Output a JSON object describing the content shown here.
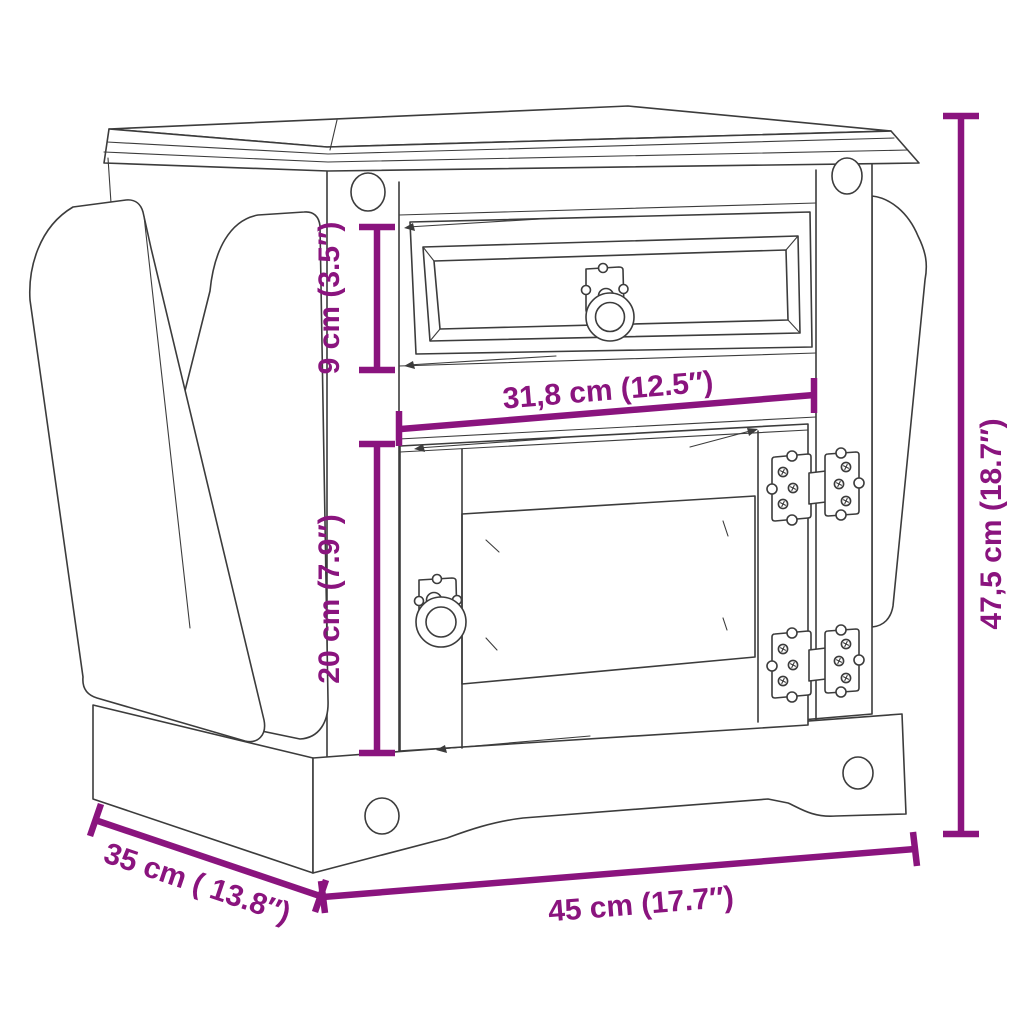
{
  "diagram": {
    "type": "furniture-dimension-diagram",
    "subject": "bedside table with drawer, door and magazine rack (line drawing)",
    "unit_system": "metric with imperial in parentheses",
    "styles": {
      "accent_color": "#8A147E",
      "line_color": "#3C3C3C",
      "background": "#ffffff"
    },
    "dimensions": [
      {
        "id": "drawer-height",
        "label": "9 cm (3.5″)",
        "value_cm": 9,
        "value_in": 3.5,
        "orientation": "vertical"
      },
      {
        "id": "door-width",
        "label": "31,8 cm (12.5″)",
        "value_cm": 31.8,
        "value_in": 12.5,
        "orientation": "horizontal"
      },
      {
        "id": "door-height",
        "label": "20 cm (7.9″)",
        "value_cm": 20,
        "value_in": 7.9,
        "orientation": "vertical"
      },
      {
        "id": "overall-height",
        "label": "47,5 cm (18.7″)",
        "value_cm": 47.5,
        "value_in": 18.7,
        "orientation": "vertical"
      },
      {
        "id": "depth",
        "label": "35 cm ( 13.8″)",
        "value_cm": 35,
        "value_in": 13.8,
        "orientation": "diagonal"
      },
      {
        "id": "overall-width",
        "label": "45 cm (17.7″)",
        "value_cm": 45,
        "value_in": 17.7,
        "orientation": "horizontal"
      }
    ],
    "parts": [
      "molded-top",
      "top-rail",
      "drawer-front",
      "drawer-ring-pull",
      "cabinet-door",
      "door-ring-pull",
      "ornate-hinge-top",
      "ornate-hinge-bottom",
      "magazine-rack-outer-panel",
      "magazine-rack-inner-panel",
      "side-wing-panel",
      "plinth-base",
      "corner-peg-details"
    ]
  }
}
